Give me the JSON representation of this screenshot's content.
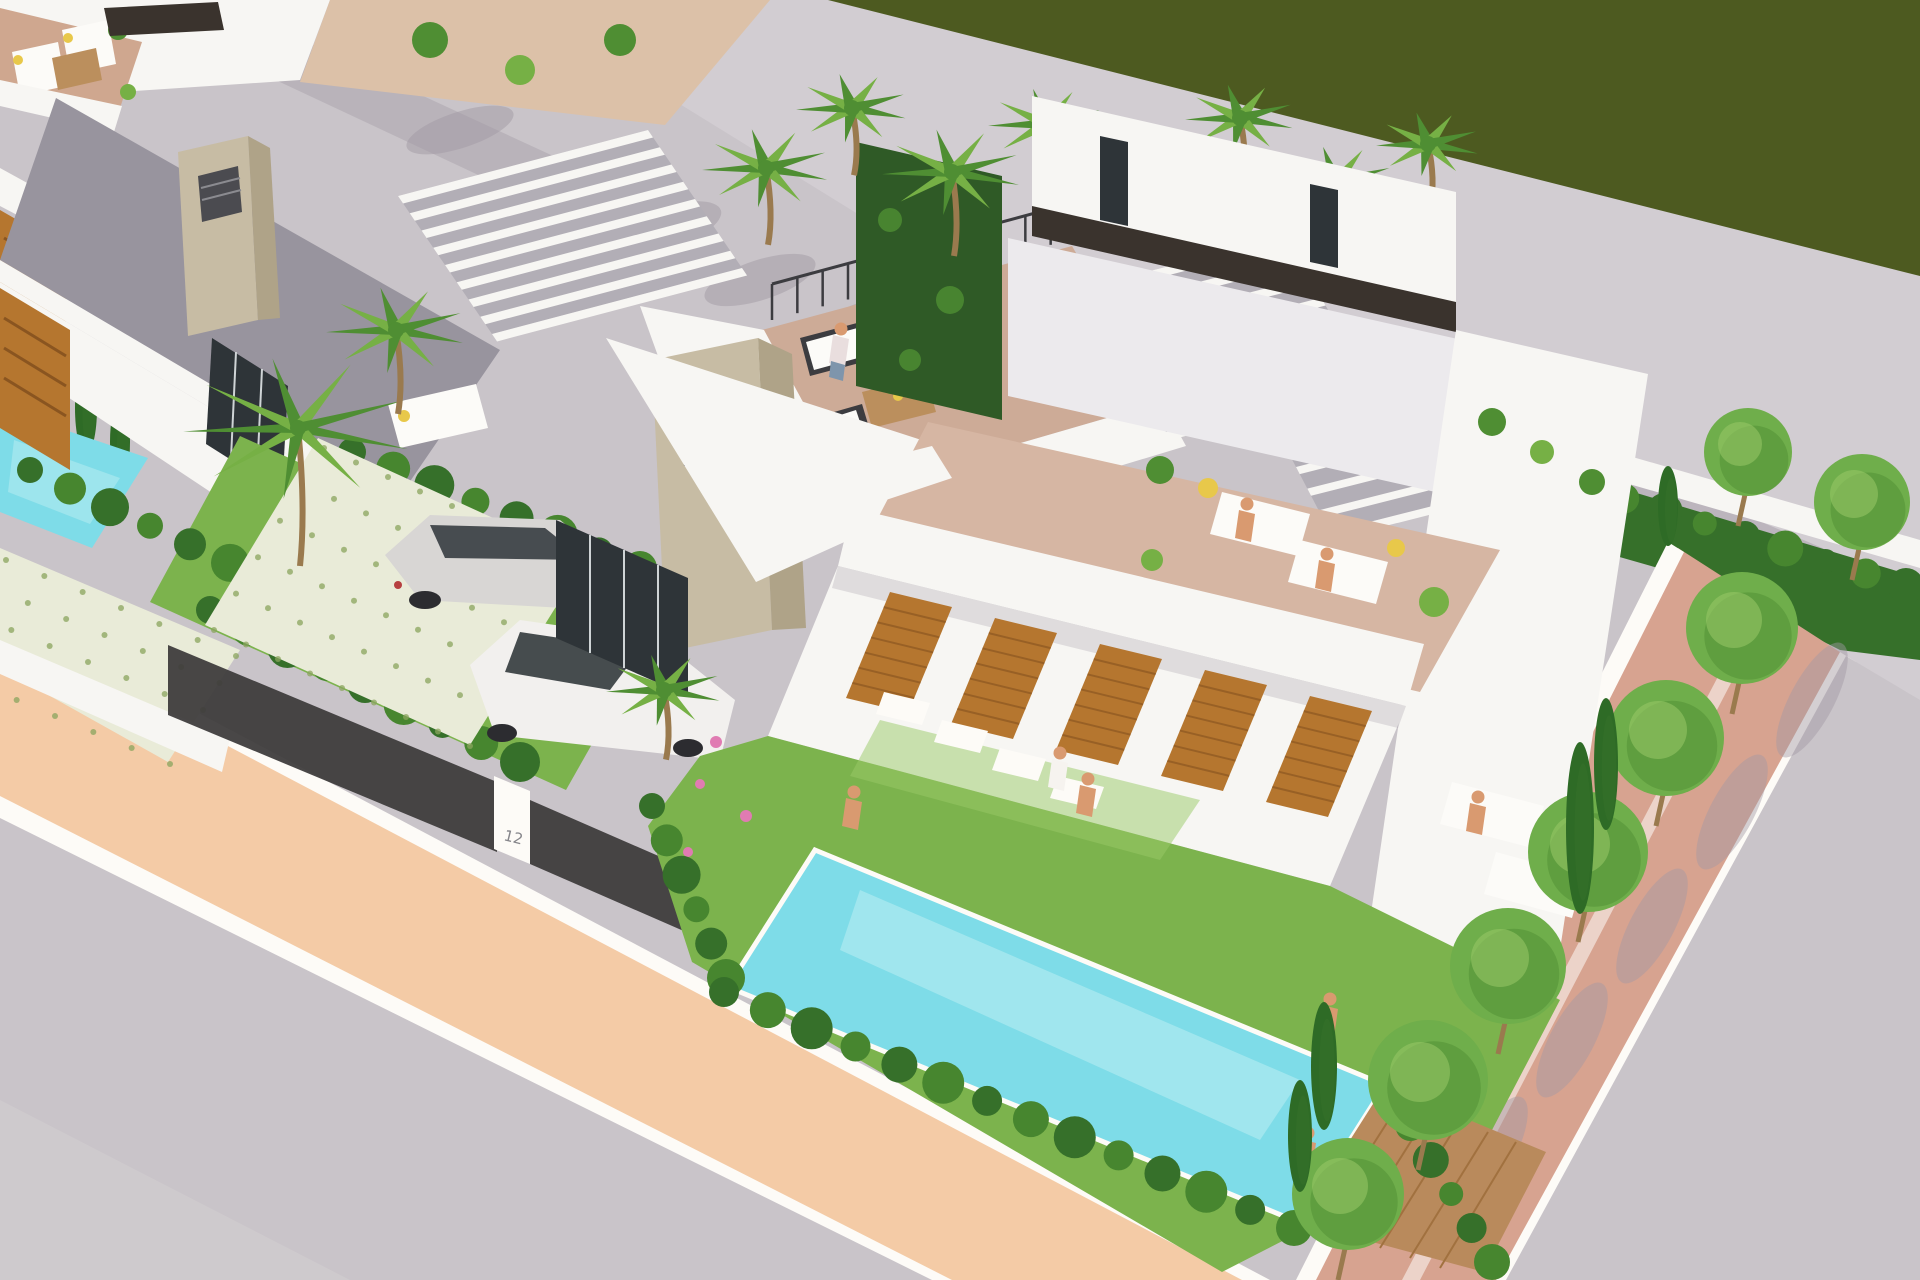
{
  "scene": {
    "type": "architectural-3d-render",
    "subject": "Aerial 3D rendering of a row of modern white villas with rooftop terraces, private gardens and turquoise pools",
    "elements": [
      "foreground asphalt road",
      "salmon sidewalk with white curbs",
      "villa with parked cars and mosaic driveway",
      "dark mesh fence with numbered gate post",
      "central villa rooftop lounge with sofas and woman",
      "stone chimneys with ventilation grilles",
      "white slatted pergolas",
      "right villa with dark roof trim band",
      "rooftop sunbathing terrace with loungers",
      "wooden slat shutters on facade",
      "lawn with stepping stones",
      "main turquoise pool with wooden deck",
      "row of palm trees",
      "brick side path with round trees",
      "upper gray road with palm and building shadows",
      "dark olive water channel",
      "cypress hedges"
    ]
  },
  "labels": {
    "gate_number": "12"
  },
  "colors": {
    "road": "#c9c4c9",
    "road_far": "#d2cdd2",
    "road_shadow": "#a49cа5",
    "shadow_soft": "#a29aa4",
    "field_olive": "#4d5a20",
    "sidewalk": "#f4cba6",
    "curb_white": "#fdfbf7",
    "brick_path": "#d7a390",
    "wall_white": "#f7f6f3",
    "wall_light": "#eceaed",
    "wall_shade": "#98949e",
    "trim_dark": "#3a332d",
    "glass_dark": "#2e3438",
    "stone": "#c7bca4",
    "stone_shade": "#afa388",
    "grille": "#4b4b50",
    "terrace_a": "#cfa78f",
    "terrace_b": "#cdab97",
    "terrace_c": "#d6b6a3",
    "pergola_gap": "#b2aeb6",
    "sand": "#dcc1a8",
    "grass": "#7cb34d",
    "grass_light": "#99c968",
    "hedge": "#47862f",
    "hedge_dark": "#36702a",
    "ivy": "#2f5a26",
    "palm": "#76b045",
    "palm_dark": "#4f8e33",
    "cypress": "#2e6b26",
    "tree": "#6fae4b",
    "trunk": "#9a7a4e",
    "pool": "#7edce8",
    "pool_light": "#bceef2",
    "deck": "#b98a5c",
    "deck_dark": "#a1713f",
    "wood_slat": "#b5762f",
    "wood_dark": "#8a5520",
    "mosaic": "#e9ebd8",
    "mosaic_dot": "#8aa45e",
    "fence_dark": "#3e3c3b",
    "car_silver": "#d8d6d4",
    "car_white": "#f2f0ee",
    "car_dark": "#26282e",
    "furniture_white": "#fcfbf8",
    "furniture_frame": "#3c3c40",
    "table_wood": "#bb8f5d",
    "skin": "#d99a70",
    "denim": "#7e95ac",
    "accent_yellow": "#e8c84a",
    "flower_pink": "#e07bb2"
  },
  "vegetation": {
    "palm_count": 11,
    "street_tree_count": 6,
    "garden_tree_count": 2,
    "cypress_count": 9
  },
  "pools": [
    {
      "id": "main-pool"
    },
    {
      "id": "side-pool"
    }
  ],
  "cars": [
    {
      "id": "silver-estate-car"
    },
    {
      "id": "white-compact-car"
    },
    {
      "id": "dark-car-roof"
    }
  ],
  "people": [
    {
      "id": "woman-on-roof-sofa",
      "x": 841,
      "y": 329,
      "body": "#e9dede",
      "legs": "denim"
    },
    {
      "id": "sunbather-roof-1",
      "x": 1247,
      "y": 504,
      "body": "skin"
    },
    {
      "id": "sunbather-roof-2",
      "x": 1327,
      "y": 554,
      "body": "skin"
    },
    {
      "id": "boy-jumping-to-pool",
      "x": 854,
      "y": 792,
      "body": "skin"
    },
    {
      "id": "woman-walking-lawn",
      "x": 1060,
      "y": 753,
      "body": "#f6f3ef"
    },
    {
      "id": "child-on-lawn",
      "x": 1088,
      "y": 779,
      "body": "skin"
    },
    {
      "id": "sunbather-lawn",
      "x": 1478,
      "y": 797,
      "body": "skin"
    },
    {
      "id": "person-kneeling-garden",
      "x": 1330,
      "y": 999,
      "body": "skin"
    },
    {
      "id": "man-sitting-pool-deck",
      "x": 1308,
      "y": 1133,
      "body": "skin"
    }
  ]
}
